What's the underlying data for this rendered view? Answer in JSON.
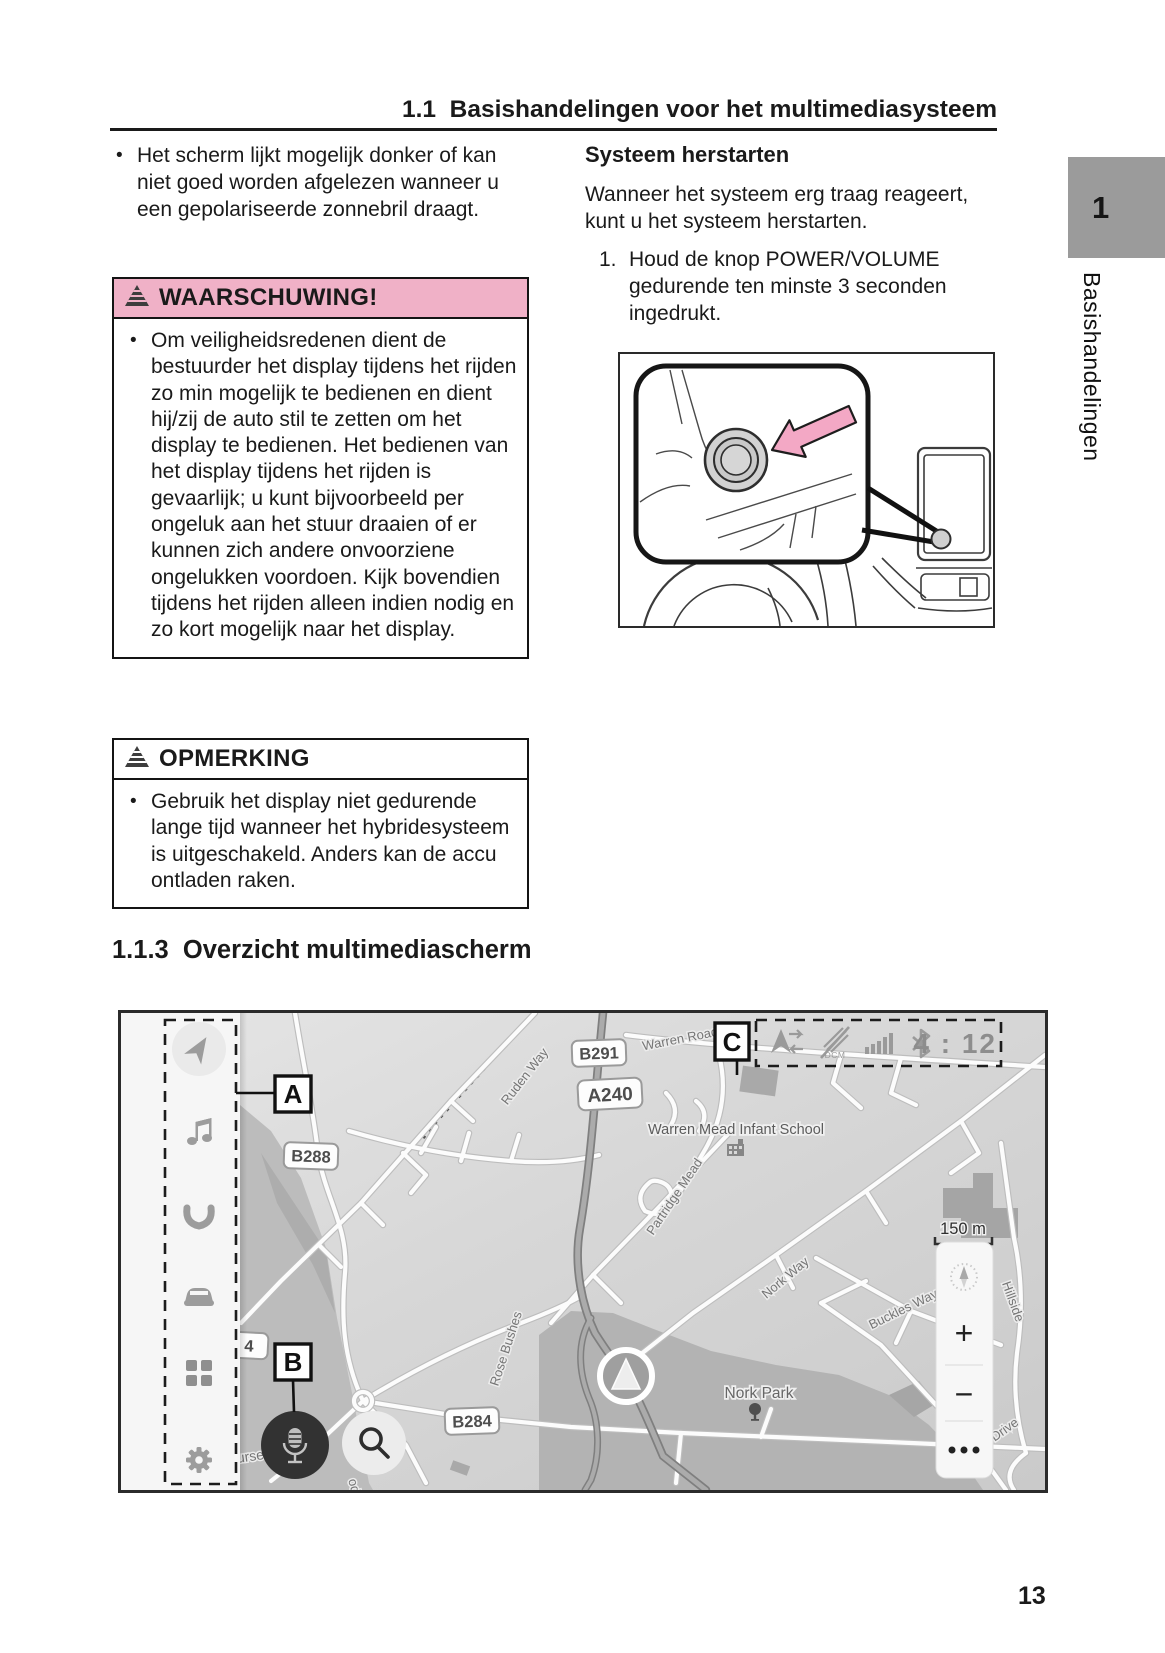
{
  "page": {
    "number": "13"
  },
  "header": {
    "title": "1.1  Basishandelingen voor het multimediasysteem"
  },
  "side_tab": {
    "chapter": "1",
    "label": "Basishandelingen"
  },
  "left_column": {
    "bullet_text": "Het scherm lijkt mogelijk donker of kan niet goed worden afgelezen wanneer u een gepolariseerde zonnebril draagt.",
    "warning": {
      "title": "WAARSCHUWING!",
      "icon": "warning-triangle-icon",
      "header_color": "#f0b1c7",
      "body": "Om veiligheidsredenen dient de bestuurder het display tijdens het rijden zo min mogelijk te bedienen en dient hij/zij de auto stil te zetten om het display te bedienen. Het bedienen van het display tijdens het rijden is gevaarlijk; u kunt bijvoorbeeld per ongeluk aan het stuur draaien of er kunnen zich andere onvoorziene ongelukken voordoen. Kijk bovendien tijdens het rijden alleen indien nodig en zo kort mogelijk naar het display."
    },
    "note": {
      "title": "OPMERKING",
      "icon": "warning-triangle-icon",
      "body": "Gebruik het display niet gedurende lange tijd wanneer het hybridesysteem is uitgeschakeld. Anders kan de accu ontladen raken."
    }
  },
  "right_column": {
    "heading": "Systeem herstarten",
    "paragraph": "Wanneer het systeem erg traag reageert, kunt u het systeem herstarten.",
    "step_number": "1.",
    "step_text": "Houd de knop POWER/VOLUME gedurende ten minste 3 seconden ingedrukt.",
    "illustration": "power-volume-knob-callout-drawing"
  },
  "section": {
    "heading": "1.1.3  Overzicht multimediascherm"
  },
  "map": {
    "callouts": {
      "a": "A",
      "b": "B",
      "c": "C"
    },
    "status": {
      "time": "4 : 12",
      "icons": [
        "nav-share-icon",
        "dcm-no-signal-icon",
        "signal-strength-icon",
        "bluetooth-icon"
      ]
    },
    "sidebar_icons": [
      "navigation-icon",
      "music-icon",
      "phone-icon",
      "car-icon",
      "apps-grid-icon",
      "settings-gear-icon"
    ],
    "shields": [
      {
        "text": "B291"
      },
      {
        "text": "A240"
      },
      {
        "text": "B288"
      },
      {
        "text": "B284"
      },
      {
        "text": "4"
      }
    ],
    "streets": [
      {
        "text": "Warren Road"
      },
      {
        "text": "Ruden Way"
      },
      {
        "text": "Partridge Mead"
      },
      {
        "text": "Rose Bushes"
      },
      {
        "text": "Nork Way"
      },
      {
        "text": "Buckles Way"
      },
      {
        "text": "Hillside"
      },
      {
        "text": "Drive"
      },
      {
        "text": "urse"
      },
      {
        "text": "od"
      }
    ],
    "pois": [
      {
        "name": "Warren Mead Infant School",
        "icon": "school-building-icon"
      },
      {
        "name": "Nork Park",
        "icon": "tree-icon"
      }
    ],
    "scale": {
      "label": "150 m"
    },
    "controls": {
      "zoom_in": "+",
      "zoom_out": "−",
      "more": "•••",
      "compass": "compass-icon"
    },
    "buttons": {
      "microphone": "microphone-button",
      "search": "search-button"
    },
    "marker": "current-location-marker"
  },
  "colors": {
    "warning_pink": "#f0b1c7",
    "arrow_pink": "#f3a8c5",
    "tab_gray": "#9b9b9b",
    "map_icon_gray": "#9c9c9c",
    "status_gray": "#9a9a9a",
    "text_dark": "#1a1a1a"
  }
}
